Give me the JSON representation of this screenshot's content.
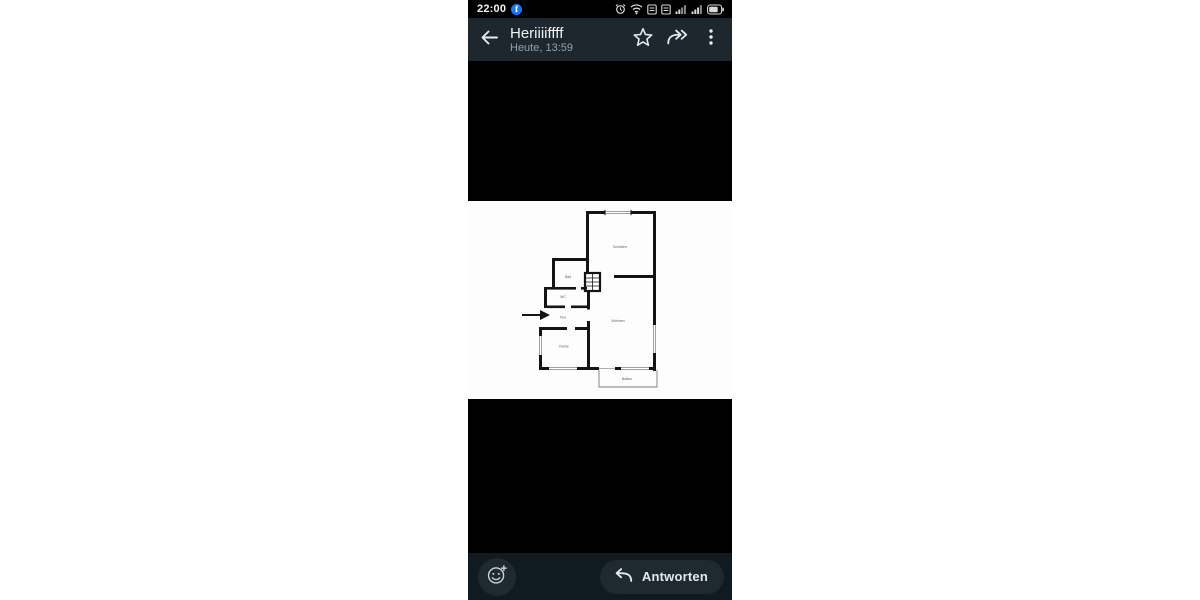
{
  "status_bar": {
    "time": "22:00",
    "facebook_logo_letter": "f",
    "icons": [
      "facebook-notification-icon",
      "alarm-icon",
      "wifi-icon",
      "volte-icon",
      "volte-icon",
      "signal-icon",
      "signal-icon",
      "battery-icon"
    ]
  },
  "app_bar": {
    "title": "Heriiiiffff",
    "subtitle": "Heute, 13:59",
    "icons": [
      "back-arrow-icon",
      "star-icon",
      "forward-icon",
      "kebab-menu-icon"
    ]
  },
  "floorplan": {
    "type": "apartment-floor-plan-image",
    "rooms": {
      "schlafen": "Schlafen",
      "bad": "Bad",
      "wc": "WC",
      "flur": "Flur",
      "wohnen": "Wohnen",
      "kueche": "Küche",
      "balkon": "Balkon"
    },
    "entrance_marker": "black-arrow-pointing-right"
  },
  "bottom_bar": {
    "reply_label": "Antworten",
    "icons": [
      "add-reaction-icon",
      "reply-arrow-icon"
    ]
  },
  "colors": {
    "viewer_bg": "#000000",
    "app_bar_bg": "#1f272e",
    "bottom_bar_bg": "#101a21",
    "button_bg": "#1e2930",
    "facebook_blue": "#1877f2",
    "title_color": "#eef2f3",
    "subtitle_color": "#94a1a9",
    "image_bg": "#fdfdfd",
    "plan_wall_color": "#141414",
    "plan_label_color": "#5f5f5f"
  }
}
